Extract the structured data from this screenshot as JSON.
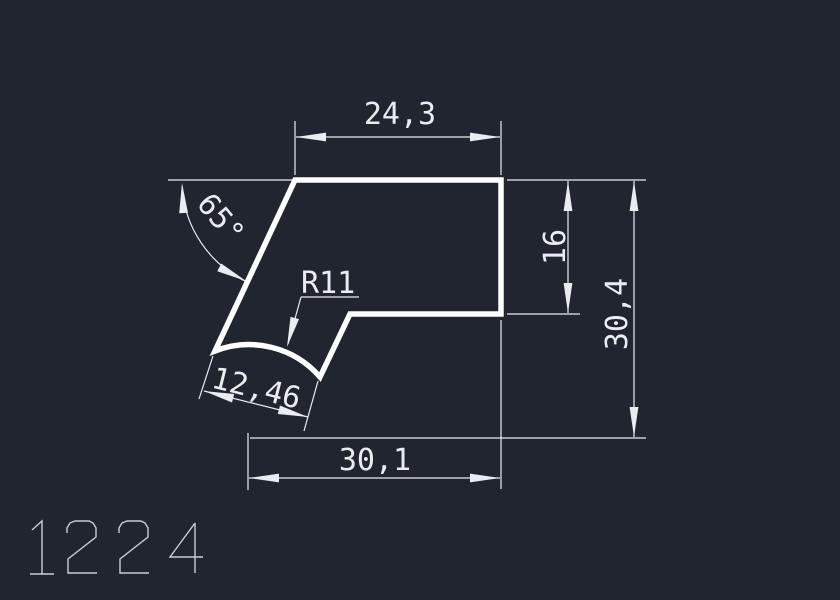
{
  "colors": {
    "background": "#202530",
    "profile": "#ffffff",
    "annotation": "#e9ecf1",
    "part_number": "#c9ced6"
  },
  "drawing": {
    "part_number": "1224",
    "dimensions": {
      "top_width": "24,3",
      "angle": "65°",
      "radius": "R11",
      "chord_length": "12,46",
      "bottom_width": "30,1",
      "step_height": "16",
      "overall_height": "30,4"
    }
  }
}
